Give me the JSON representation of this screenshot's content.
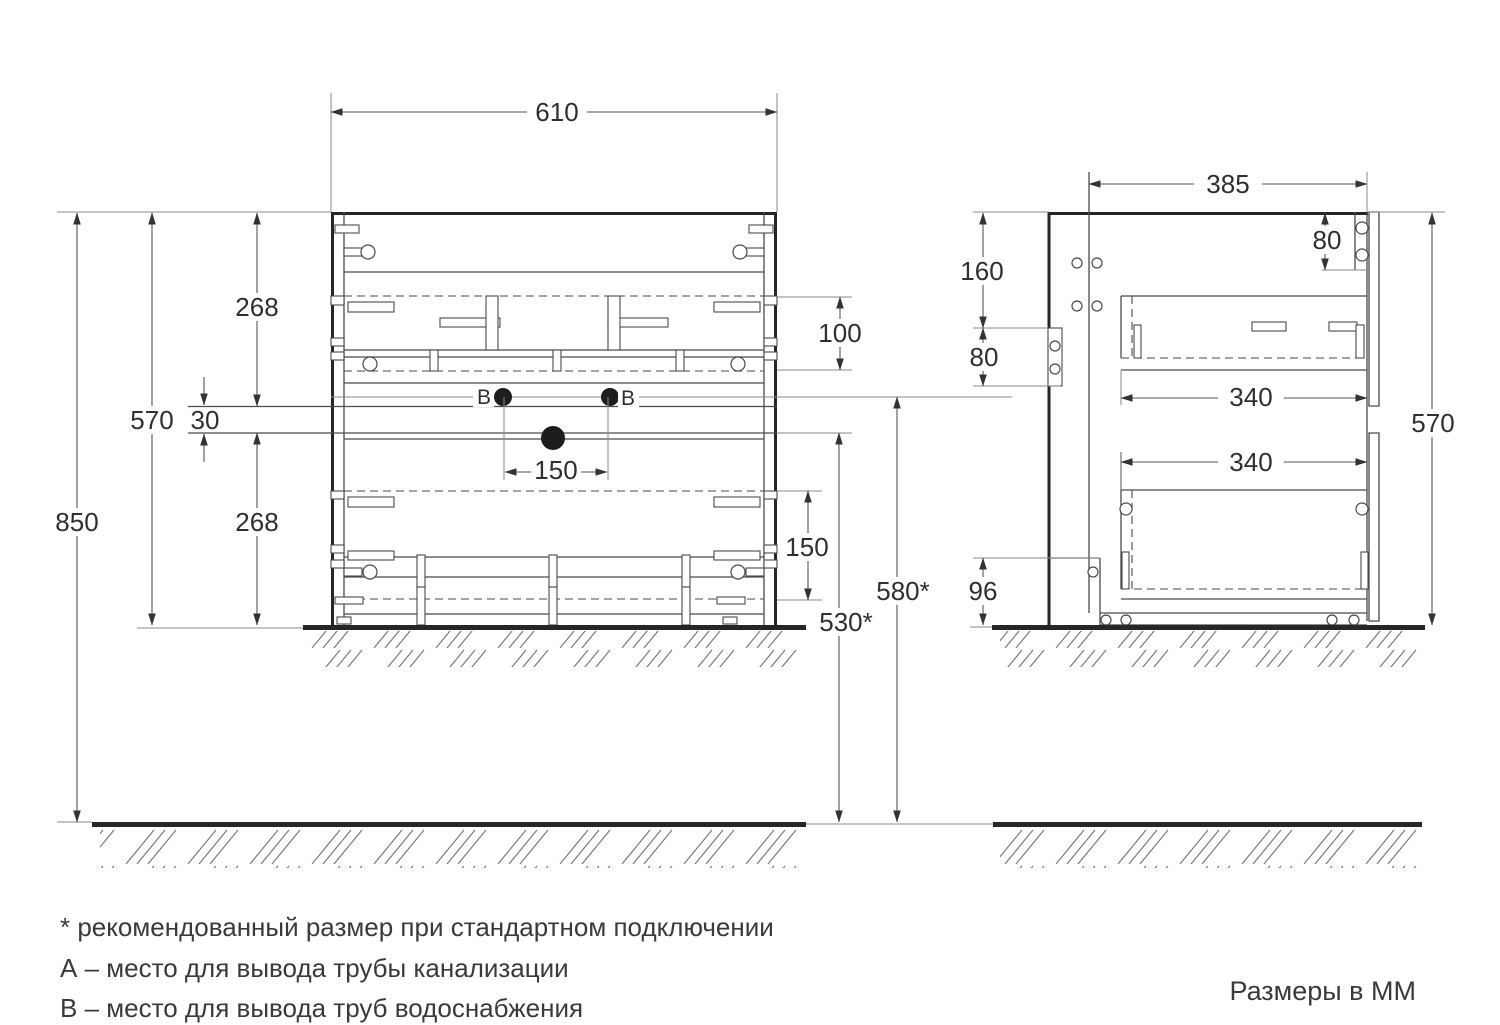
{
  "document": {
    "units_note": "Размеры в ММ",
    "footnotes": [
      "* рекомендованный размер при стандартном подключении",
      "А – место для вывода трубы канализации",
      "В – место для вывода труб водоснабжения"
    ]
  },
  "front_view": {
    "width": "610",
    "overall_height": "850",
    "cabinet_height": "570",
    "upper_drawer_front": "268",
    "drawer_gap": "30",
    "lower_drawer_front": "268",
    "upper_mech_height": "100",
    "supply_holes_spacing": "150",
    "lower_mech_height": "150",
    "drain_outlet_height": "530*",
    "supply_outlet_height": "580*",
    "hole_label_left": "В",
    "hole_label_right": "В"
  },
  "side_view": {
    "depth": "385",
    "back_top_offset": "160",
    "hanger_bracket_height": "80",
    "front_top_offset": "80",
    "upper_drawer_depth": "340",
    "lower_drawer_depth": "340",
    "cabinet_height": "570",
    "bottom_clearance": "96"
  }
}
